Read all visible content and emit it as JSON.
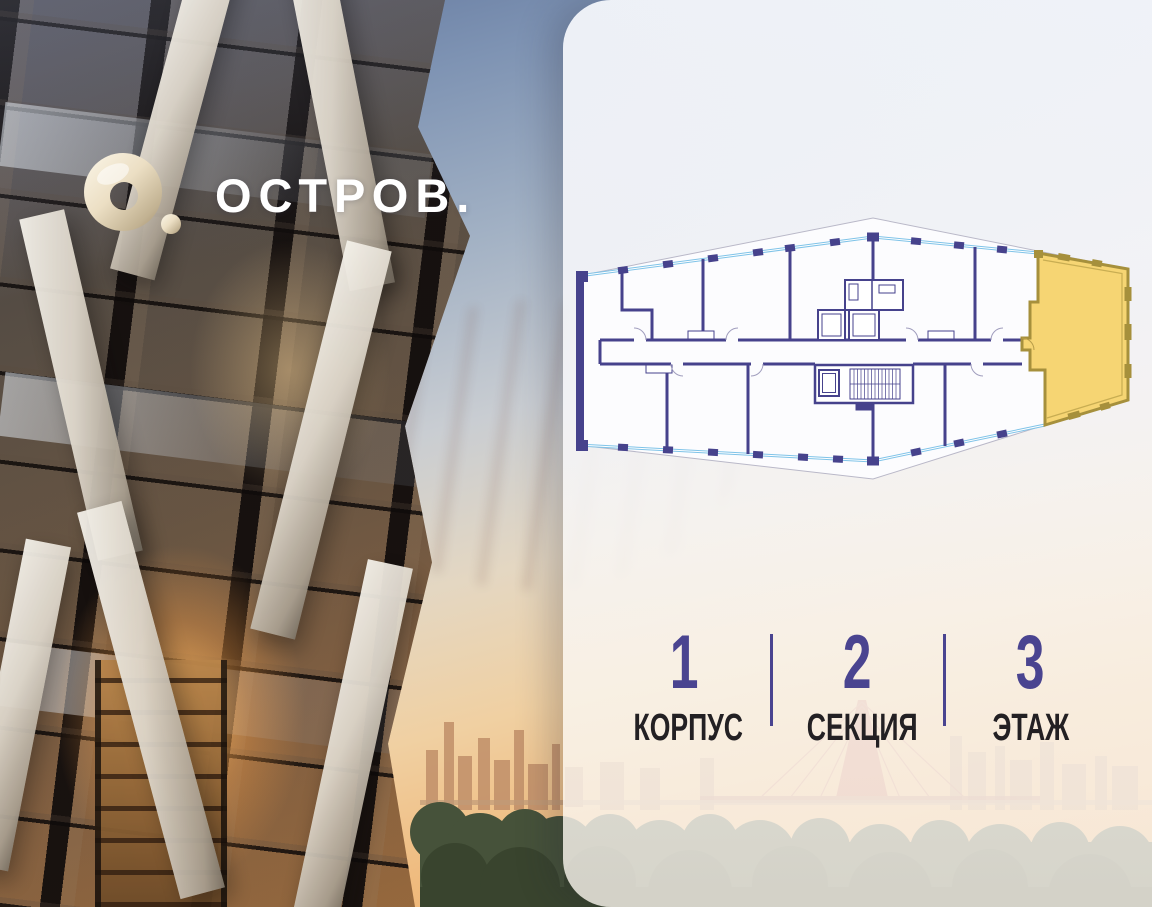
{
  "brand": {
    "name": "ОСТРОВ."
  },
  "panel": {
    "floorplan": {
      "highlight_color": "#f6d573",
      "wall_color": "#46428c",
      "window_color": "#7fc3e8"
    },
    "info": {
      "accent_color": "#4a4490",
      "items": [
        {
          "value": "1",
          "label": "КОРПУС"
        },
        {
          "value": "2",
          "label": "СЕКЦИЯ"
        },
        {
          "value": "3",
          "label": "ЭТАЖ"
        }
      ]
    }
  }
}
